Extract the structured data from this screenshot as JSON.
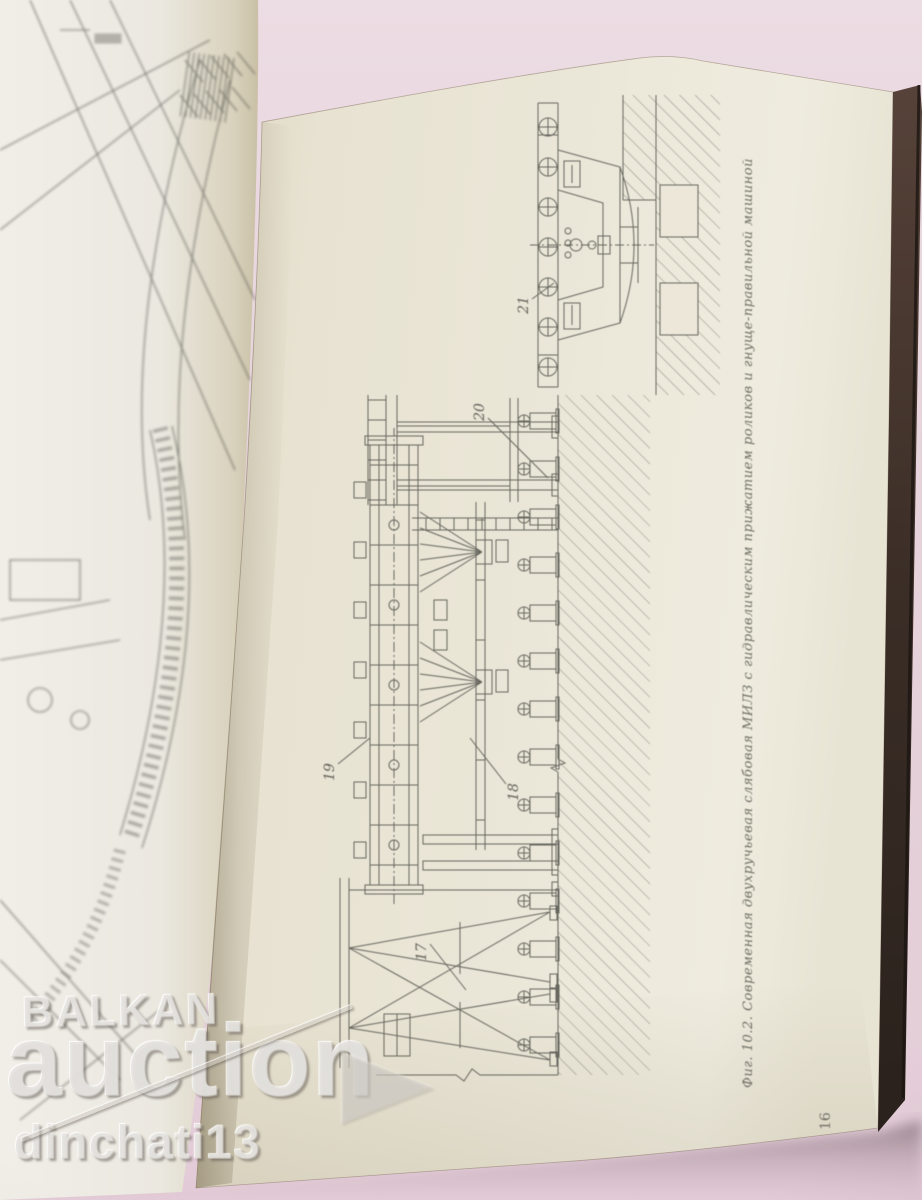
{
  "book": {
    "right_page": {
      "figure_caption": "Фиг. 10.2. Современная двухручьевая слябовая МИЛЗ с гидравлическим прижатием роликов и гнуще-правильной машиной",
      "page_number": "16",
      "figure_labels": [
        {
          "text": "21"
        },
        {
          "text": "20"
        },
        {
          "text": "19"
        },
        {
          "text": "18"
        },
        {
          "text": "17"
        }
      ]
    }
  },
  "watermarks": {
    "brand_top": "BALKAN",
    "brand_main": "auction",
    "seller": "dinchati13"
  },
  "colors": {
    "table_pink": "#e6d3db",
    "page_cream": "#e9e5d6",
    "page_light": "#f0ede6",
    "cover_dark": "#3a2d26",
    "drawing_ink": "#50504a",
    "watermark_gray": "#d0cac4"
  }
}
